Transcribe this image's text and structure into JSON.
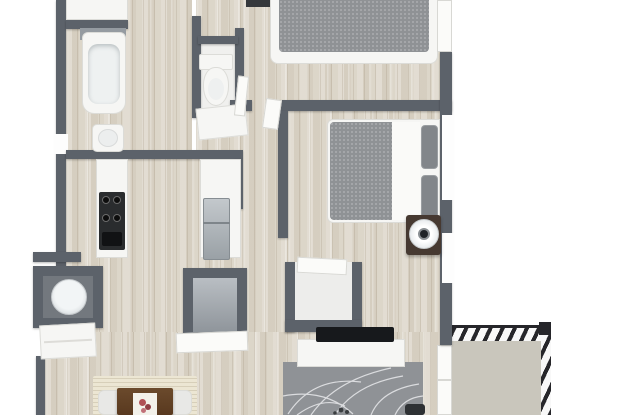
{
  "meta": {
    "view": "3d-floor-plan-render",
    "visible_text": []
  },
  "colors": {
    "bg": "#ffffff",
    "wall_dark": "#5c626a",
    "wall_light": "#6a7077",
    "wood_base": "#d8d2c6",
    "tile_white": "#f0f0ee",
    "fixture_white": "#f6f6f4",
    "fixture_border": "#dcdcd8",
    "bed_blanket_gray": "#8f9295",
    "pillow_gray": "#82868a",
    "mattress_white": "#fafaf8",
    "stainless_light": "#c3c8cc",
    "stainless_dark": "#9aa1a6",
    "stove_black": "#2a2c2e",
    "nightstand_dark_wood": "#463931",
    "tv_black": "#17191c",
    "balcony_floor": "#c9c6bc",
    "railing_black": "#26262a",
    "rug_gray": "#8f9296",
    "rug_line_white": "#e9eaec",
    "dining_rug_cream": "#ece6d3",
    "table_brown": "#6b4a2c",
    "flower_red": "#b05055",
    "closet_interior_gray": "#b9bec3",
    "washer_white": "#f2f5f6"
  },
  "rooms": [
    {
      "id": "bathroom",
      "area": "top-left"
    },
    {
      "id": "water-closet",
      "area": "top-center"
    },
    {
      "id": "bedroom-1",
      "area": "top-right"
    },
    {
      "id": "kitchen",
      "area": "mid-left"
    },
    {
      "id": "hallway",
      "area": "center"
    },
    {
      "id": "bedroom-2",
      "area": "mid-right"
    },
    {
      "id": "laundry-closet",
      "area": "lower-left"
    },
    {
      "id": "dining-area",
      "area": "bottom-left"
    },
    {
      "id": "living-room",
      "area": "bottom-right"
    },
    {
      "id": "balcony",
      "area": "bottom-right-outside"
    }
  ],
  "objects": [
    "bathtub",
    "bathroom-sink",
    "toilet",
    "bathroom-cabinet",
    "stove-cooktop",
    "kitchen-counter-left",
    "kitchen-counter-right",
    "refrigerator",
    "bed-1",
    "bed-2",
    "nightstand-1",
    "nightstand-2",
    "fan-on-nightstand",
    "washer",
    "laundry-cabinet",
    "closet-a",
    "closet-b",
    "tv-soundbar",
    "media-console",
    "floral-area-rug",
    "dining-rug",
    "dining-table",
    "table-runner",
    "flower-centerpiece",
    "dining-chair-left",
    "dining-chair-right",
    "balcony-railing-top",
    "balcony-railing-right",
    "balcony-sliding-door"
  ]
}
